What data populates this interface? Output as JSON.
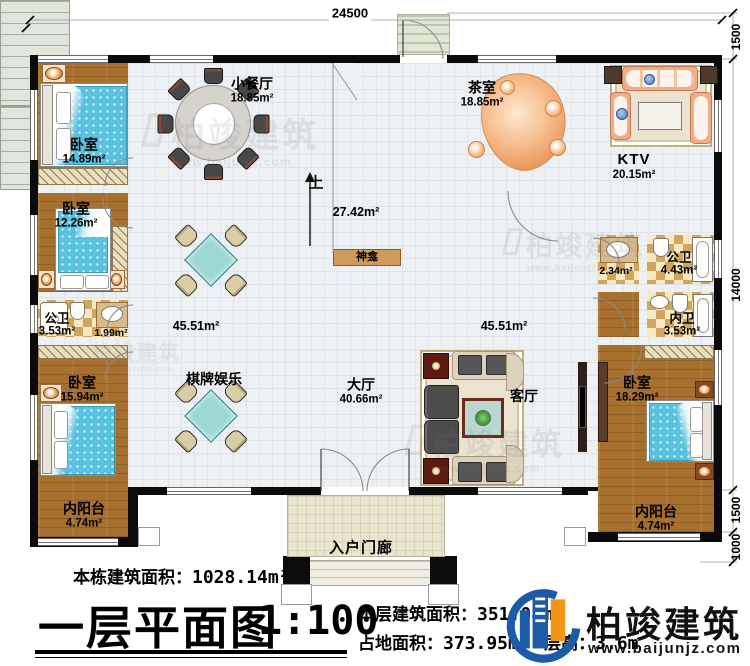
{
  "plan": {
    "annotations": {
      "total_label": "本栋建筑面积：",
      "total_value": "1028.14m²",
      "title": "一层平面图",
      "scale": "1:100",
      "floor_label": "本层建筑面积：",
      "floor_value": "351.08m²",
      "land_label": "占地面积：",
      "land_value": "373.95m²",
      "height_label": "层高：",
      "height_value": "3.6m"
    }
  },
  "rooms": [
    {
      "name": "卧室",
      "area": "14.89m²"
    },
    {
      "name": "卧室",
      "area": "12.26m²"
    },
    {
      "name": "公卫",
      "area": "3.53m²"
    },
    {
      "name": "",
      "area": "1.99m²"
    },
    {
      "name": "卧室",
      "area": "15.94m²"
    },
    {
      "name": "内阳台",
      "area": "4.74m²"
    },
    {
      "name": "小餐厅",
      "area": "18.85m²"
    },
    {
      "name": "茶室",
      "area": "18.85m²"
    },
    {
      "name": "KTV",
      "area": "20.15m²"
    },
    {
      "name": "",
      "area": "27.42m²"
    },
    {
      "name": "",
      "area": "45.51m²"
    },
    {
      "name": "",
      "area": "45.51m²"
    },
    {
      "name": "棋牌娱乐",
      "area": ""
    },
    {
      "name": "大厅",
      "area": "40.66m²"
    },
    {
      "name": "客厅",
      "area": ""
    },
    {
      "name": "神龛",
      "area": ""
    },
    {
      "name": "上",
      "area": ""
    },
    {
      "name": "",
      "area": "2.34m²"
    },
    {
      "name": "公卫",
      "area": "4.43m²"
    },
    {
      "name": "内卫",
      "area": "3.53m²"
    },
    {
      "name": "卧室",
      "area": "18.29m²"
    },
    {
      "name": "内阳台",
      "area": "4.74m²"
    },
    {
      "name": "入户门廊",
      "area": ""
    }
  ],
  "dimensions": {
    "top": "24500",
    "right_top": "1500",
    "right_main": "14000",
    "right_lower": "1500",
    "right_bottom": "1000"
  },
  "brand": {
    "name": "柏竣建筑",
    "url": "www.baijunjz.com"
  },
  "watermark": {
    "name": "柏竣建筑",
    "url": "www.baijunjz.com"
  }
}
